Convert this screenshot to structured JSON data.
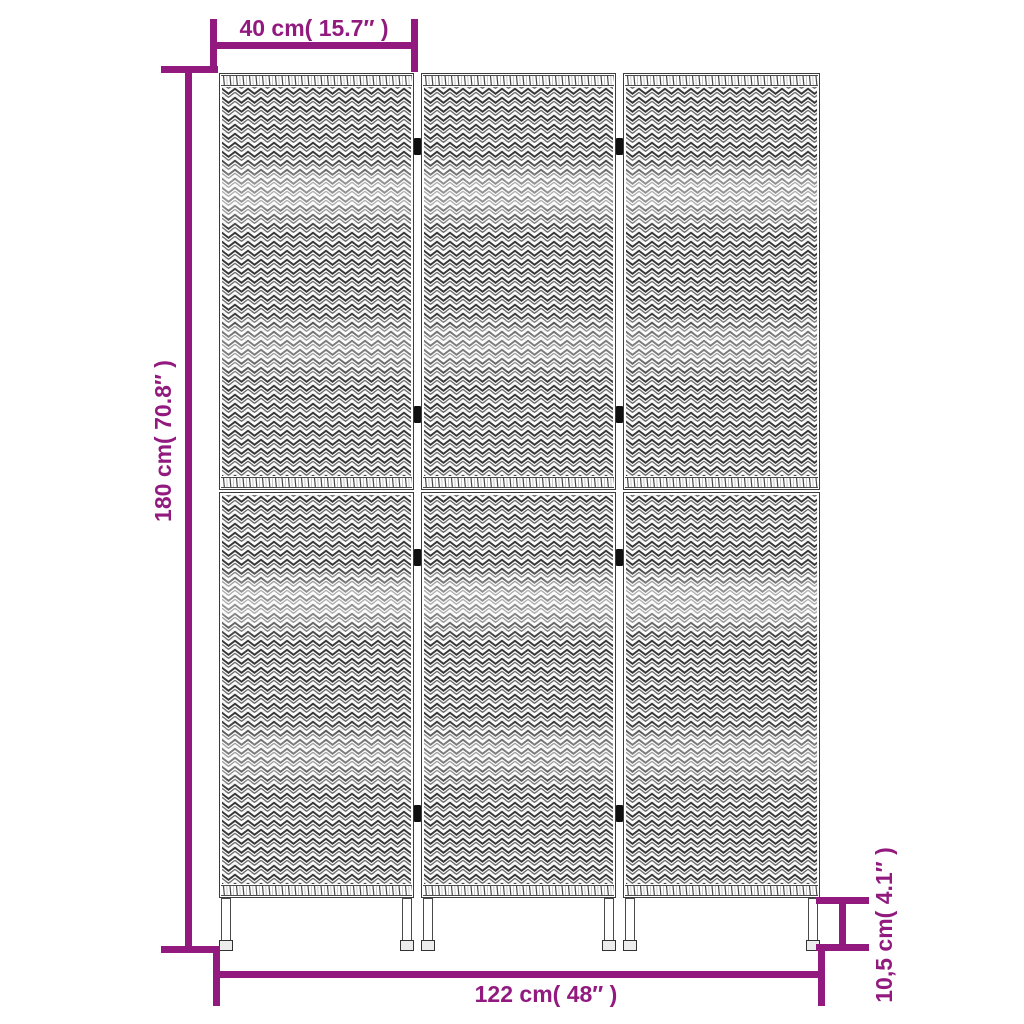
{
  "figure": {
    "kind": "product-dimension-diagram",
    "subject": "3-panel woven room divider",
    "panel_count": 3,
    "sections_per_panel": 2,
    "hinge_positions": 8,
    "legs": 6
  },
  "dimensions": {
    "panel_width": {
      "label": "40 cm( 15.7″ )"
    },
    "height": {
      "label": "180 cm( 70.8″ )"
    },
    "total_width": {
      "label": "122 cm( 48″ )"
    },
    "leg_height": {
      "label": "10,5 cm( 4.1″ )"
    }
  },
  "colors": {
    "dimension_accent": "#921a7f",
    "outline": "#3c3c3c",
    "hinge": "#101010",
    "background": "#ffffff"
  }
}
